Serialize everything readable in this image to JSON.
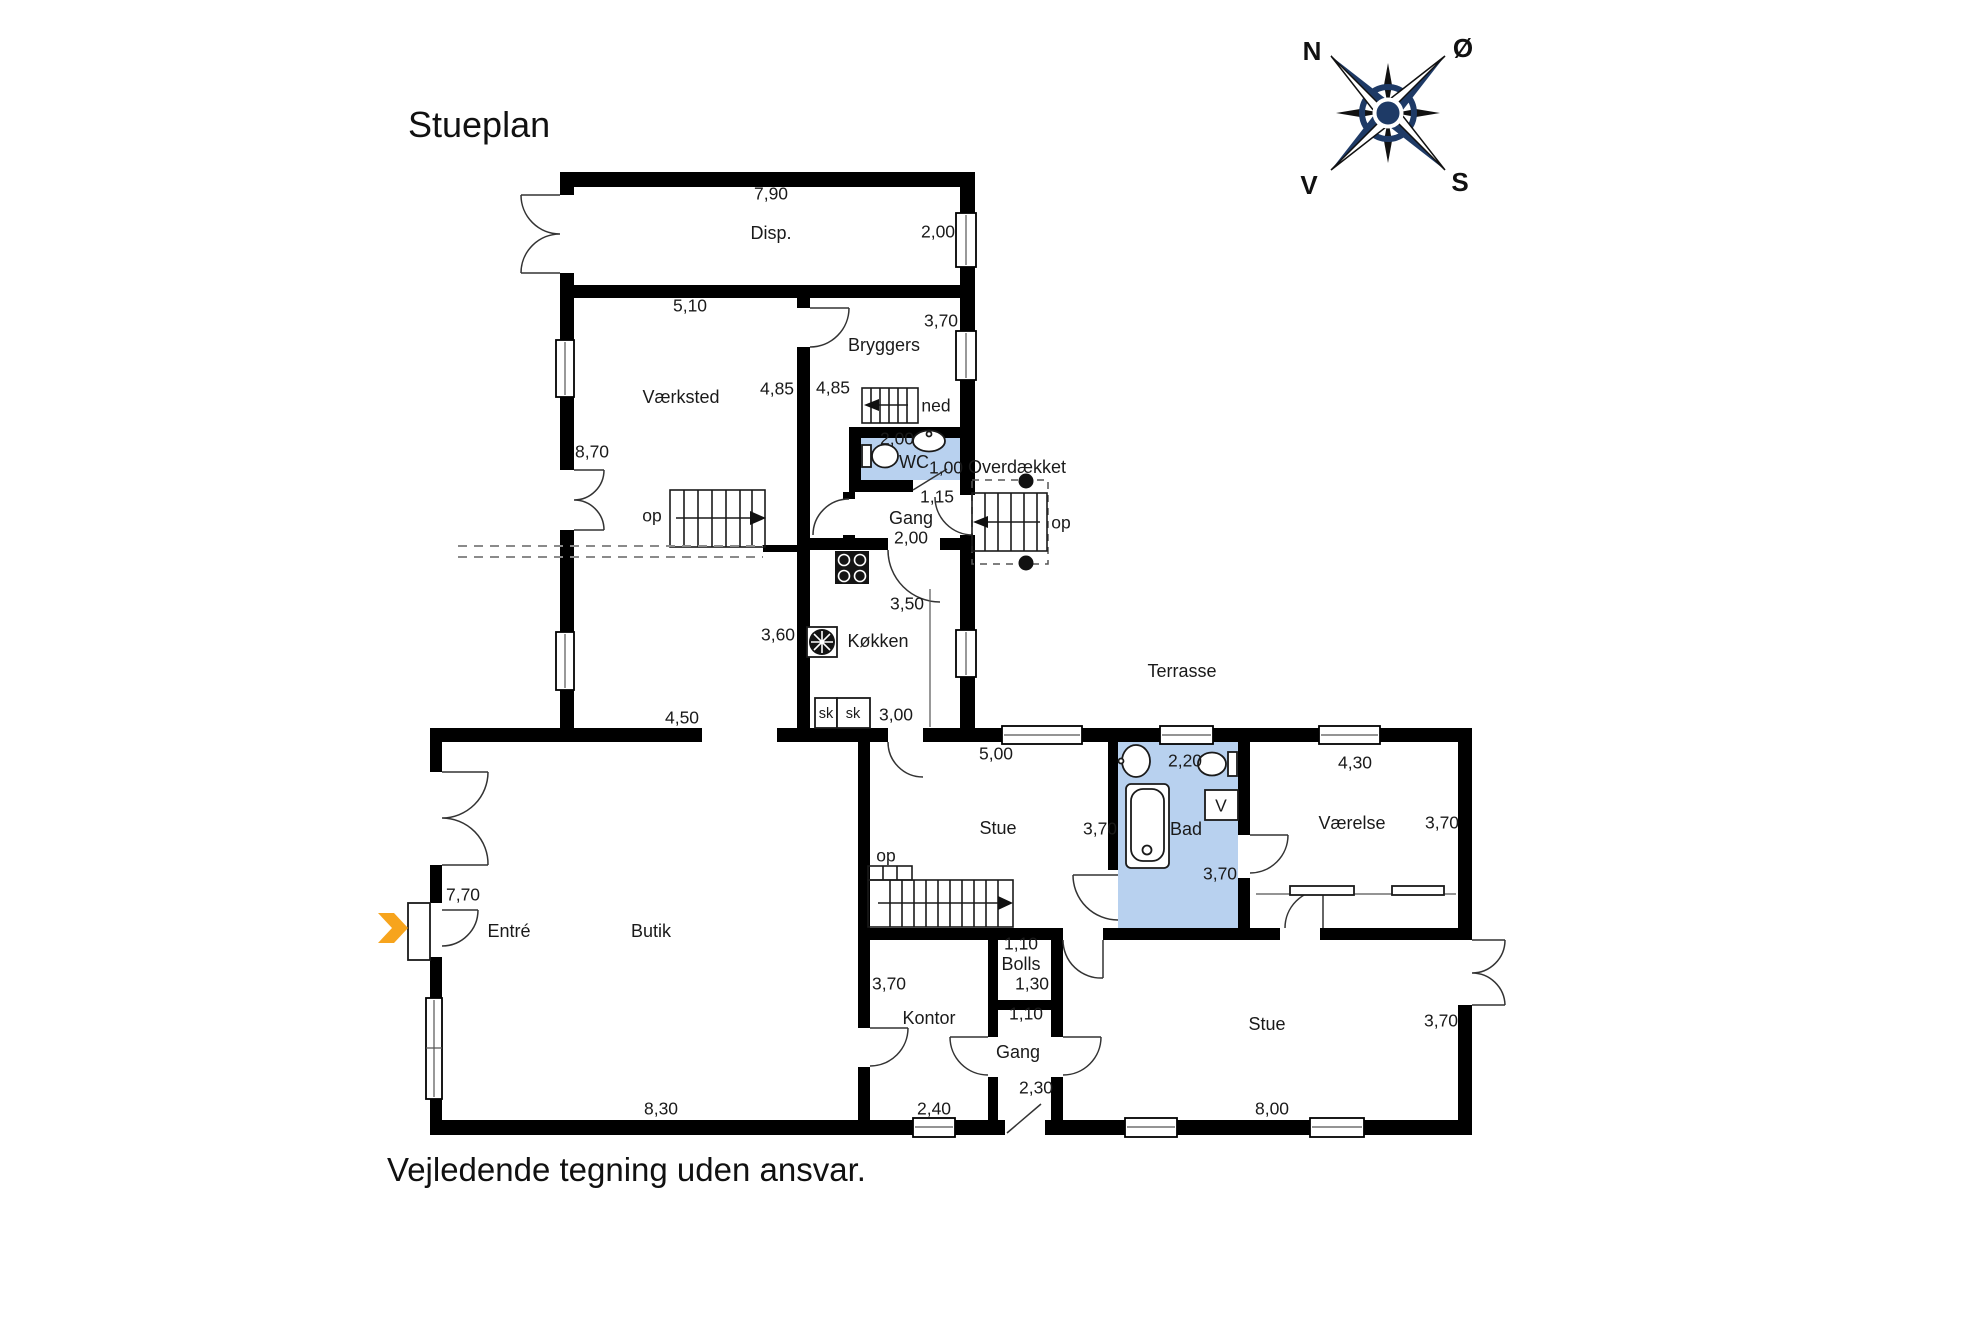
{
  "title": "Stueplan",
  "disclaimer": "Vejledende tegning uden ansvar.",
  "compass": {
    "north": "N",
    "east": "Ø",
    "south": "S",
    "west": "V"
  },
  "colors": {
    "wall": "#000000",
    "wet_room_fill": "#b8d1ef",
    "entry_arrow": "#f7a41d",
    "compass_navy": "#1e3a66"
  },
  "rooms": {
    "disp": "Disp.",
    "vaerksted": "Værksted",
    "bryggers": "Bryggers",
    "wc": "WC",
    "gang_north": "Gang",
    "koekken": "Køkken",
    "stue_mid": "Stue",
    "bad": "Bad",
    "vaerelse": "Værelse",
    "entre": "Entré",
    "butik": "Butik",
    "kontor": "Kontor",
    "bolls": "Bolls",
    "gang_south": "Gang",
    "stue_south": "Stue",
    "terrasse": "Terrasse",
    "overdaekket": "Overdækket"
  },
  "dims": {
    "disp_w": "7,90",
    "disp_d": "2,00",
    "vaerksted_w": "5,10",
    "bryggers_d": "3,70",
    "vaerksted_d": "4,85",
    "bryggers_d2": "4,85",
    "vaerksted_h": "8,70",
    "wc_w": "2,00",
    "wc_d": "1,00",
    "gang_n_w": "1,15",
    "gang_n_d": "2,00",
    "koekken_d": "3,50",
    "koekken_w": "3,60",
    "koekken_b": "3,00",
    "butik_top": "4,50",
    "stue_mid_w": "5,00",
    "bad_w": "2,20",
    "vaerelse_w": "4,30",
    "stue_mid_d": "3,70",
    "vaerelse_d": "3,70",
    "butik_h": "7,70",
    "bad_d": "3,70",
    "bolls_w": "1,10",
    "bolls_d": "1,30",
    "kontor_d": "3,70",
    "gang_s_w": "1,10",
    "gang_s_d": "2,30",
    "kontor_w": "2,40",
    "butik_w": "8,30",
    "stue_s_w": "8,00",
    "stue_s_d": "3,70"
  },
  "annotations": {
    "stair_up_vaerksted": "op",
    "stair_down_bryggers": "ned",
    "stair_up_outside": "op",
    "stair_up_stue": "op",
    "cabinet_1": "sk",
    "cabinet_2": "sk",
    "appliance_v": "V"
  }
}
